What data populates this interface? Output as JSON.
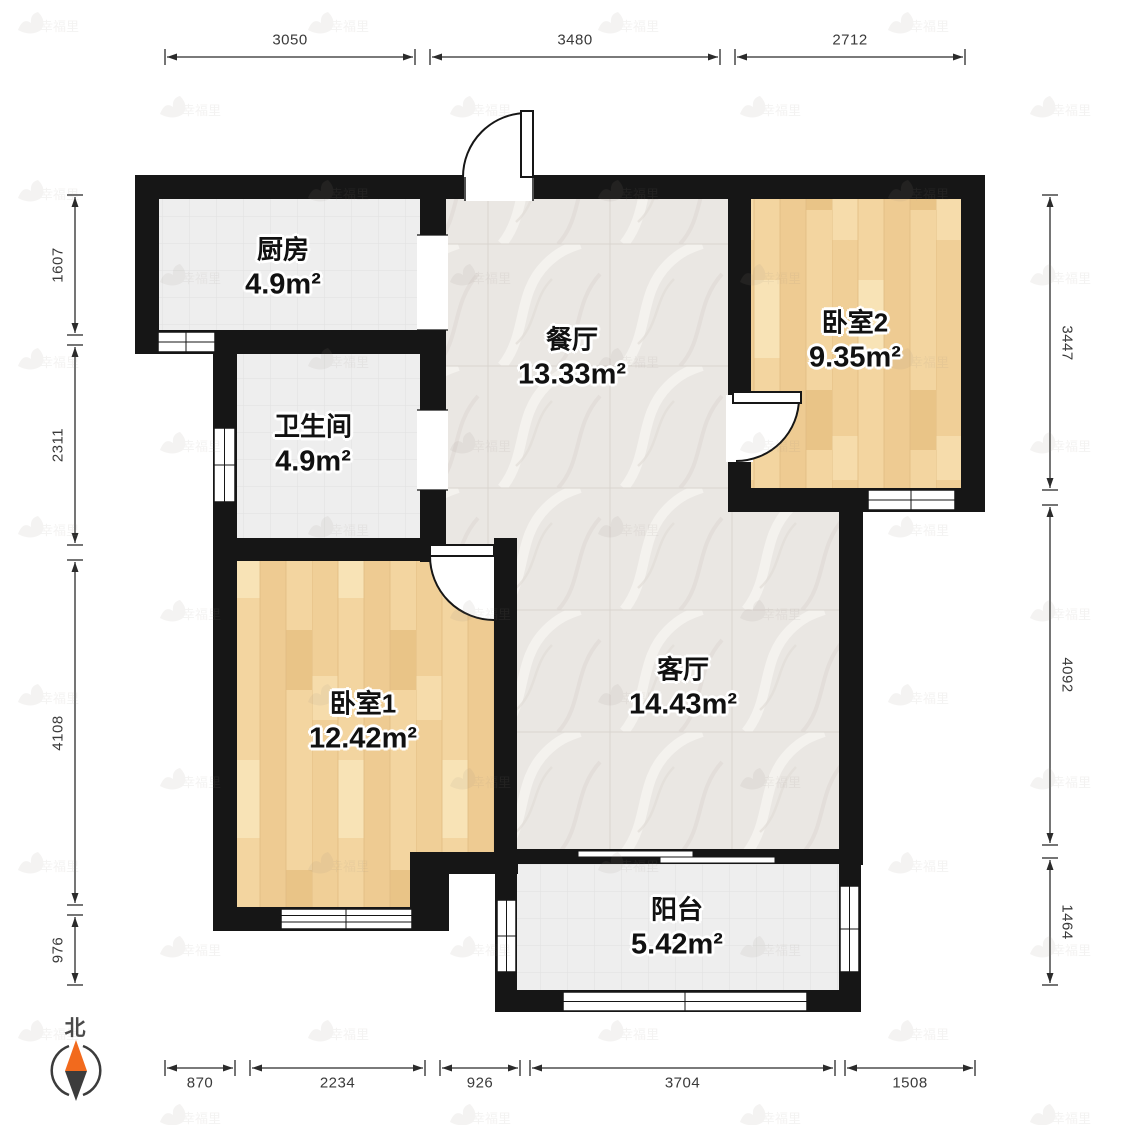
{
  "compass": {
    "label": "北"
  },
  "watermark": {
    "text": "幸福里"
  },
  "rooms": [
    {
      "id": "kitchen",
      "label": "厨房",
      "area": "4.9m²"
    },
    {
      "id": "dining",
      "label": "餐厅",
      "area": "13.33m²"
    },
    {
      "id": "bathroom",
      "label": "卫生间",
      "area": "4.9m²"
    },
    {
      "id": "bedroom1",
      "label": "卧室1",
      "area": "12.42m²"
    },
    {
      "id": "bedroom2",
      "label": "卧室2",
      "area": "9.35m²"
    },
    {
      "id": "living",
      "label": "客厅",
      "area": "14.43m²"
    },
    {
      "id": "balcony",
      "label": "阳台",
      "area": "5.42m²"
    }
  ],
  "dimensions": {
    "top": [
      "3050",
      "3480",
      "2712"
    ],
    "left": [
      "1607",
      "2311",
      "4108",
      "976"
    ],
    "right": [
      "3447",
      "4092",
      "1464"
    ],
    "bottom": [
      "870",
      "2234",
      "926",
      "3704",
      "1508"
    ]
  },
  "colors": {
    "wall": "#161616",
    "wood_floor": "#f2d29c",
    "tile_floor": "#eeeeee",
    "marble_floor": "#eae7e3",
    "compass_north": "#f26a1d"
  }
}
